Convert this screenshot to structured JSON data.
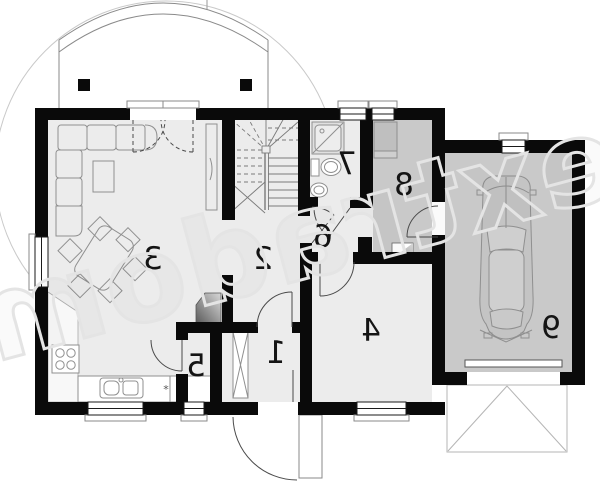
{
  "watermark": {
    "text": "extradom"
  },
  "rooms": [
    {
      "number": "1"
    },
    {
      "number": "2"
    },
    {
      "number": "3"
    },
    {
      "number": "4"
    },
    {
      "number": "5"
    },
    {
      "number": "6"
    },
    {
      "number": "7"
    },
    {
      "number": "8"
    },
    {
      "number": "9"
    }
  ],
  "symbols": {
    "kitchen_note": "*"
  },
  "colors": {
    "wall": "#0a0a0a",
    "floor_light": "#ececec",
    "floor_dark": "#c9c9c9",
    "fixture_stroke": "#8f8f8f",
    "door_stroke": "#4a4a4a",
    "site_line": "#c9c9c9",
    "watermark": "#e4e4e4"
  }
}
